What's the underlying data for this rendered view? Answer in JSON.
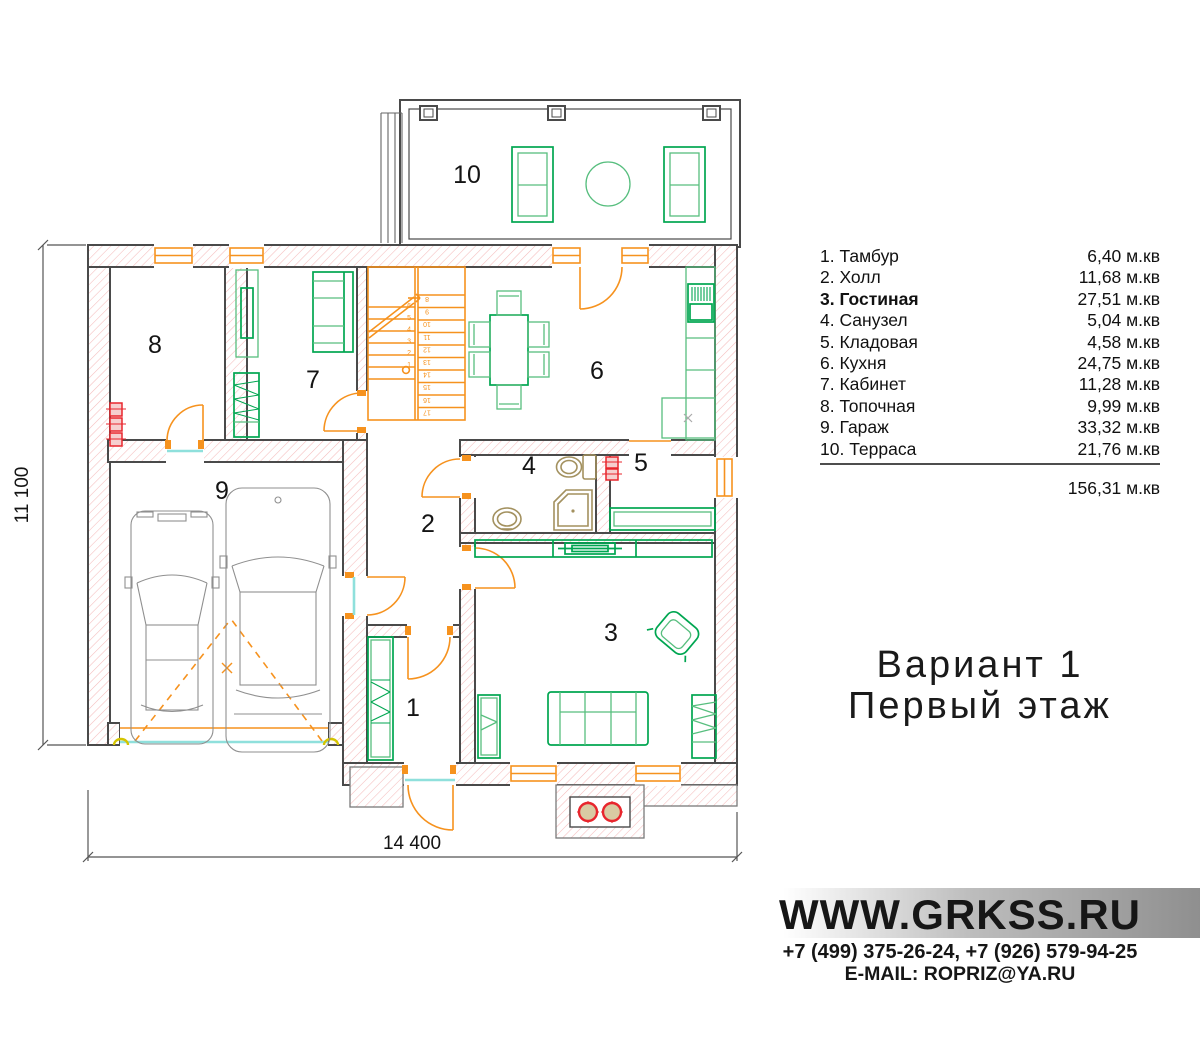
{
  "plan": {
    "room_numbers": {
      "r1": "1",
      "r2": "2",
      "r3": "3",
      "r4": "4",
      "r5": "5",
      "r6": "6",
      "r7": "7",
      "r8": "8",
      "r9": "9",
      "r10": "10"
    },
    "dimensions": {
      "width": "14 400",
      "height": "11 100"
    },
    "stairs": {
      "left": [
        "6",
        "5",
        "4",
        "3",
        "2",
        "1"
      ],
      "right": [
        "8",
        "9",
        "10",
        "11",
        "12",
        "13",
        "14",
        "15",
        "16",
        "17"
      ]
    }
  },
  "legend": {
    "items": [
      {
        "name": "1. Тамбур",
        "area": "6,40 м.кв"
      },
      {
        "name": "2. Холл",
        "area": "11,68 м.кв"
      },
      {
        "name": "3. Гостиная",
        "area": "27,51 м.кв"
      },
      {
        "name": "4. Санузел",
        "area": "5,04 м.кв"
      },
      {
        "name": "5. Кладовая",
        "area": "4,58 м.кв"
      },
      {
        "name": "6. Кухня",
        "area": "24,75 м.кв"
      },
      {
        "name": "7. Кабинет",
        "area": "11,28 м.кв"
      },
      {
        "name": "8. Топочная",
        "area": "9,99 м.кв"
      },
      {
        "name": "9. Гараж",
        "area": "33,32 м.кв"
      },
      {
        "name": "10. Терраса",
        "area": "21,76 м.кв"
      }
    ],
    "total": "156,31 м.кв"
  },
  "title": {
    "line1": "Вариант 1",
    "line2": "Первый этаж"
  },
  "footer": {
    "website": "WWW.GRKSS.RU",
    "phone": "+7 (499) 375-26-24, +7 (926) 579-94-25",
    "email": "E-MAIL: ROPRIZ@YA.RU"
  },
  "colors": {
    "accent_orange": "#F6921E",
    "furniture_green": "#00A651",
    "wall_dark": "#4A4A4A",
    "hatch_pink": "#F5BCBC",
    "threshold_cyan": "#8FE0DC",
    "boiler_red": "#E8262D",
    "sanitary_tan": "#A3915F"
  }
}
